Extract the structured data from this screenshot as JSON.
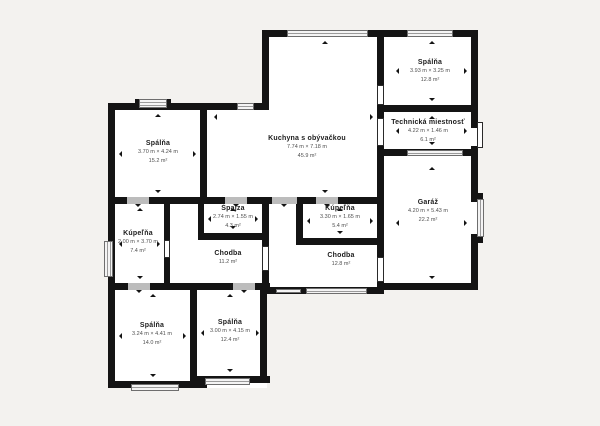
{
  "plan": {
    "rooms": {
      "kitchen": {
        "name": "Kuchyna s obývačkou",
        "dims": "7.74 m × 7.18 m",
        "area": "45.9 m²"
      },
      "bedroom_tr": {
        "name": "Spálňa",
        "dims": "3.93 m × 3.25 m",
        "area": "12.8 m²"
      },
      "technical": {
        "name": "Technická miestnosť",
        "dims": "4.22 m × 1.46 m",
        "area": "6.1 m²"
      },
      "garage": {
        "name": "Garáž",
        "dims": "4.20 m × 5.43 m",
        "area": "22.2 m²"
      },
      "bedroom_tl": {
        "name": "Spálňa",
        "dims": "3.70 m × 4.24 m",
        "area": "15.2 m²"
      },
      "spajza": {
        "name": "Špajza",
        "dims": "2.74 m × 1.55 m",
        "area": "4.3 m²"
      },
      "bathroom_r": {
        "name": "Kúpeľňa",
        "dims": "3.30 m × 1.65 m",
        "area": "5.4 m²"
      },
      "bathroom_l": {
        "name": "Kúpeľňa",
        "dims": "2.00 m × 3.70 m",
        "area": "7.4 m²"
      },
      "hall_l": {
        "name": "Chodba",
        "area": "11.2 m²"
      },
      "hall_r": {
        "name": "Chodba",
        "area": "12.8 m²"
      },
      "bedroom_bl": {
        "name": "Spálňa",
        "dims": "3.24 m × 4.41 m",
        "area": "14.0 m²"
      },
      "bedroom_bm": {
        "name": "Spálňa",
        "dims": "3.00 m × 4.15 m",
        "area": "12.4 m²"
      }
    },
    "colors": {
      "background": "#f3f2ef",
      "wall": "#141414",
      "room": "#ffffff",
      "window_stripe": "#9a9a9a",
      "door_gap": "#bcbcbc"
    }
  }
}
